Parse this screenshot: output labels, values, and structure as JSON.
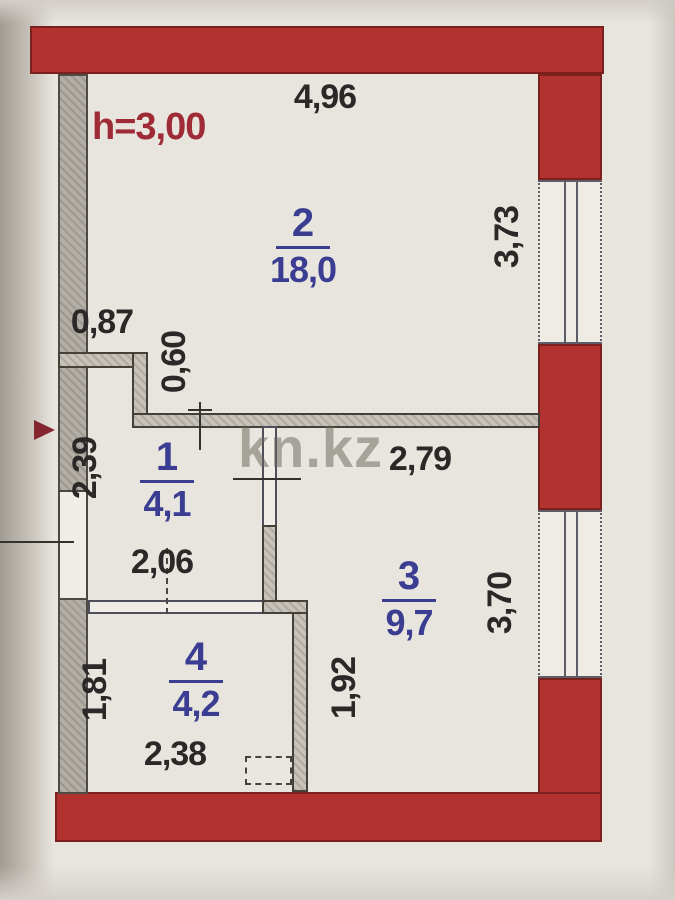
{
  "plan": {
    "watermark": "kn.kz",
    "ceiling_height": "h=3,00",
    "rooms": {
      "r1": {
        "number": "1",
        "area": "4,1"
      },
      "r2": {
        "number": "2",
        "area": "18,0"
      },
      "r3": {
        "number": "3",
        "area": "9,7"
      },
      "r4": {
        "number": "4",
        "area": "4,2"
      }
    },
    "dims": {
      "top_width": "4,96",
      "right_upper": "3,73",
      "right_lower": "3,70",
      "niche_width": "0,87",
      "niche_depth": "0,60",
      "left_height": "2,39",
      "room3_width": "2,79",
      "hall_width": "2,06",
      "room4_height": "1,81",
      "wall_length": "1,92",
      "room4_width": "2,38"
    },
    "colors": {
      "wall_red": "#b23230",
      "room_label_blue": "#3a3d92",
      "height_note_red": "#9e2b36",
      "dimension_ink": "#2a2927",
      "paper": "#e8e5de"
    }
  }
}
